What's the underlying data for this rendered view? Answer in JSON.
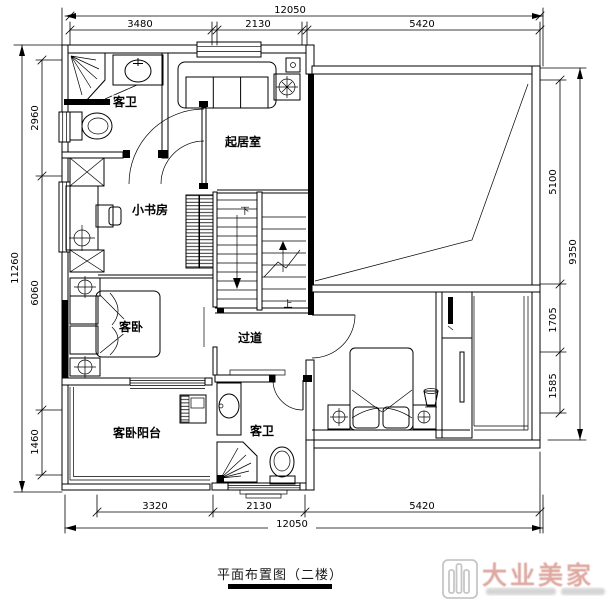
{
  "title": "平面布置图（二楼）",
  "rooms": {
    "bath_upper": "客卫",
    "living": "起居室",
    "study": "小书房",
    "bedroom_guest": "客卧",
    "corridor": "过道",
    "balcony": "客卧阳台",
    "bath_lower": "客卫"
  },
  "stairs": {
    "up": "上",
    "down": "下"
  },
  "dims": {
    "top": {
      "overall": "12050",
      "seg1": "3480",
      "seg2": "2130",
      "seg3": "5420"
    },
    "bottom": {
      "overall": "12050",
      "seg1": "3320",
      "seg2": "2130",
      "seg3": "5420"
    },
    "left": {
      "overall": "11260",
      "seg1": "2960",
      "seg2": "6060",
      "seg3": "1460"
    },
    "right": {
      "overall": "9350",
      "seg1": "5100",
      "seg2": "1705",
      "seg3": "1585"
    }
  },
  "logo": {
    "name": "大业美家"
  },
  "colors": {
    "line": "#000000",
    "logo_text": "#dfa8a0",
    "logo_icon": "#c6c6c6",
    "bg": "#ffffff"
  }
}
